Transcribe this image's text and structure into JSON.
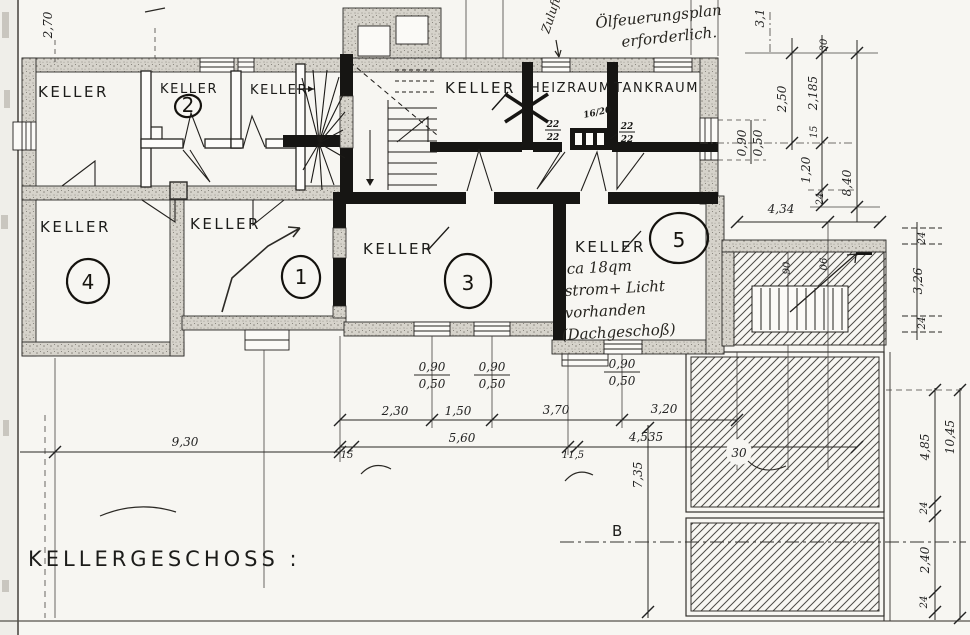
{
  "title": "KELLERGESCHOSS :",
  "annotations": {
    "heating_note_line1": "Ölfeuerungsplan",
    "heating_note_line2": "erforderlich.",
    "zuluft": "Zuluft",
    "room5_note_line1": "ca 18qm",
    "room5_note_line2": "strom+ Licht",
    "room5_note_line3": "vorhanden",
    "room5_note_line4": "(Dachgeschoß)",
    "section_marker": "B"
  },
  "rooms": {
    "keller_top_left": "KELLER",
    "keller_2": "KELLER",
    "keller_2_number": "2",
    "keller_stairs": "KELLER",
    "keller_mid": "KELLER",
    "heizraum": "HEIZRAUM",
    "tankraum": "TANKRAUM",
    "keller_4": "KELLER",
    "keller_4_number": "4",
    "keller_1": "KELLER",
    "keller_1_number": "1",
    "keller_3": "KELLER",
    "keller_3_number": "3",
    "keller_5": "KELLER",
    "keller_5_number": "5"
  },
  "flues": {
    "flue_size": "16/20",
    "flue_a_top": "22",
    "flue_a_bottom": "22",
    "flue_b_top": "22",
    "flue_b_bottom": "22"
  },
  "dims": {
    "v270": "2,70",
    "v31": "3,1",
    "v30_top": "30",
    "v250": "2,50",
    "v2185": "2,185",
    "v15_right": "15",
    "v090_right": "0,90",
    "v050_right": "0,50",
    "v120": "1,20",
    "v24_right": "24",
    "v840": "8,40",
    "v434": "4,34",
    "v90_stair": "90",
    "v06_stair": "06",
    "v24_a": "24",
    "v326": "3,26",
    "v24_b": "24",
    "v485": "4,85",
    "v1045": "10,45",
    "v24_c": "24",
    "v240": "2,40",
    "v24_d": "24",
    "v30_hatch": "30",
    "v320": "3,20",
    "v735": "7,35",
    "win1_top": "0,90",
    "win1_bottom": "0,50",
    "win2_top": "0,90",
    "win2_bottom": "0,50",
    "win3_top": "0,90",
    "win3_bottom": "0,50",
    "v230": "2,30",
    "v150": "1,50",
    "v370": "3,70",
    "v15_bottom": "15",
    "v560": "5,60",
    "v115": "11,5",
    "v4535": "4,535",
    "v930": "9,30"
  }
}
